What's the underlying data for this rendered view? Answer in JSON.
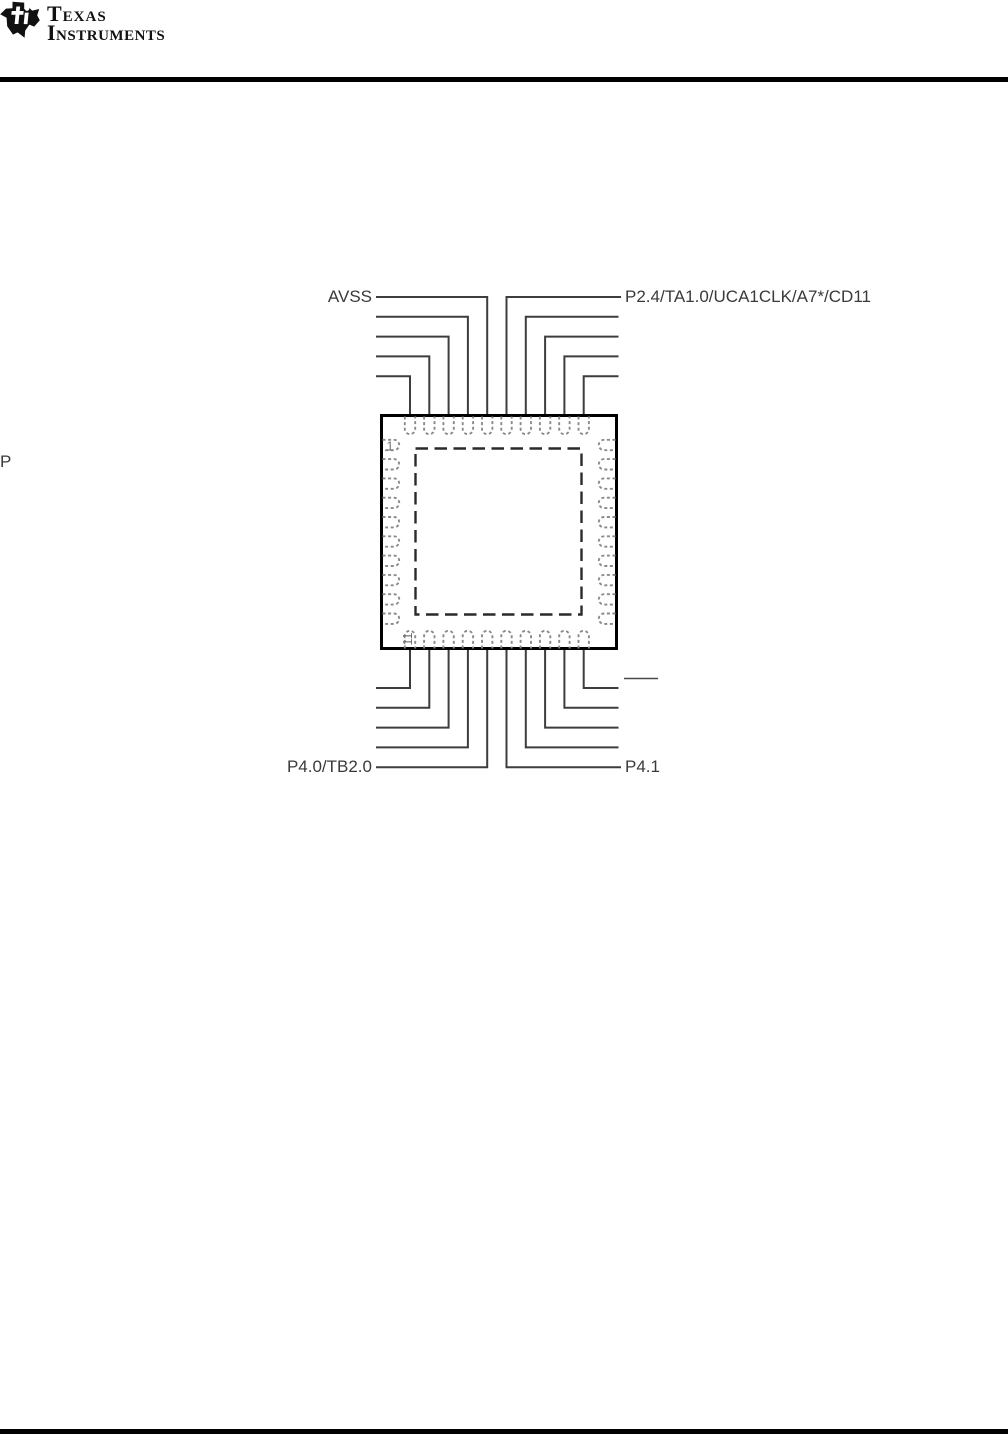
{
  "document": {
    "header": {
      "brand_line1": "Texas",
      "brand_line2": "Instruments"
    },
    "pinout": {
      "pins_per_side": 10,
      "pin_labels": {
        "top_left_pin": "AVSS",
        "top_right_pin": "P2.4/TA1.0/UCA1CLK/A7*/CD11",
        "bottom_left_pin": "P4.0/TB2.0",
        "bottom_right_pin": "P4.1",
        "left_edge_fragment": "P"
      },
      "pin_markers": {
        "pin1": "1",
        "pin11": "11"
      },
      "colors": {
        "lead_line": "#3d3d3d",
        "package_border": "#000000",
        "pad_outline": "#8a8a8a",
        "exposed_pad_dash": "#2a2a2a",
        "label_text": "#3a3a3a",
        "rule": "#000000"
      }
    }
  }
}
